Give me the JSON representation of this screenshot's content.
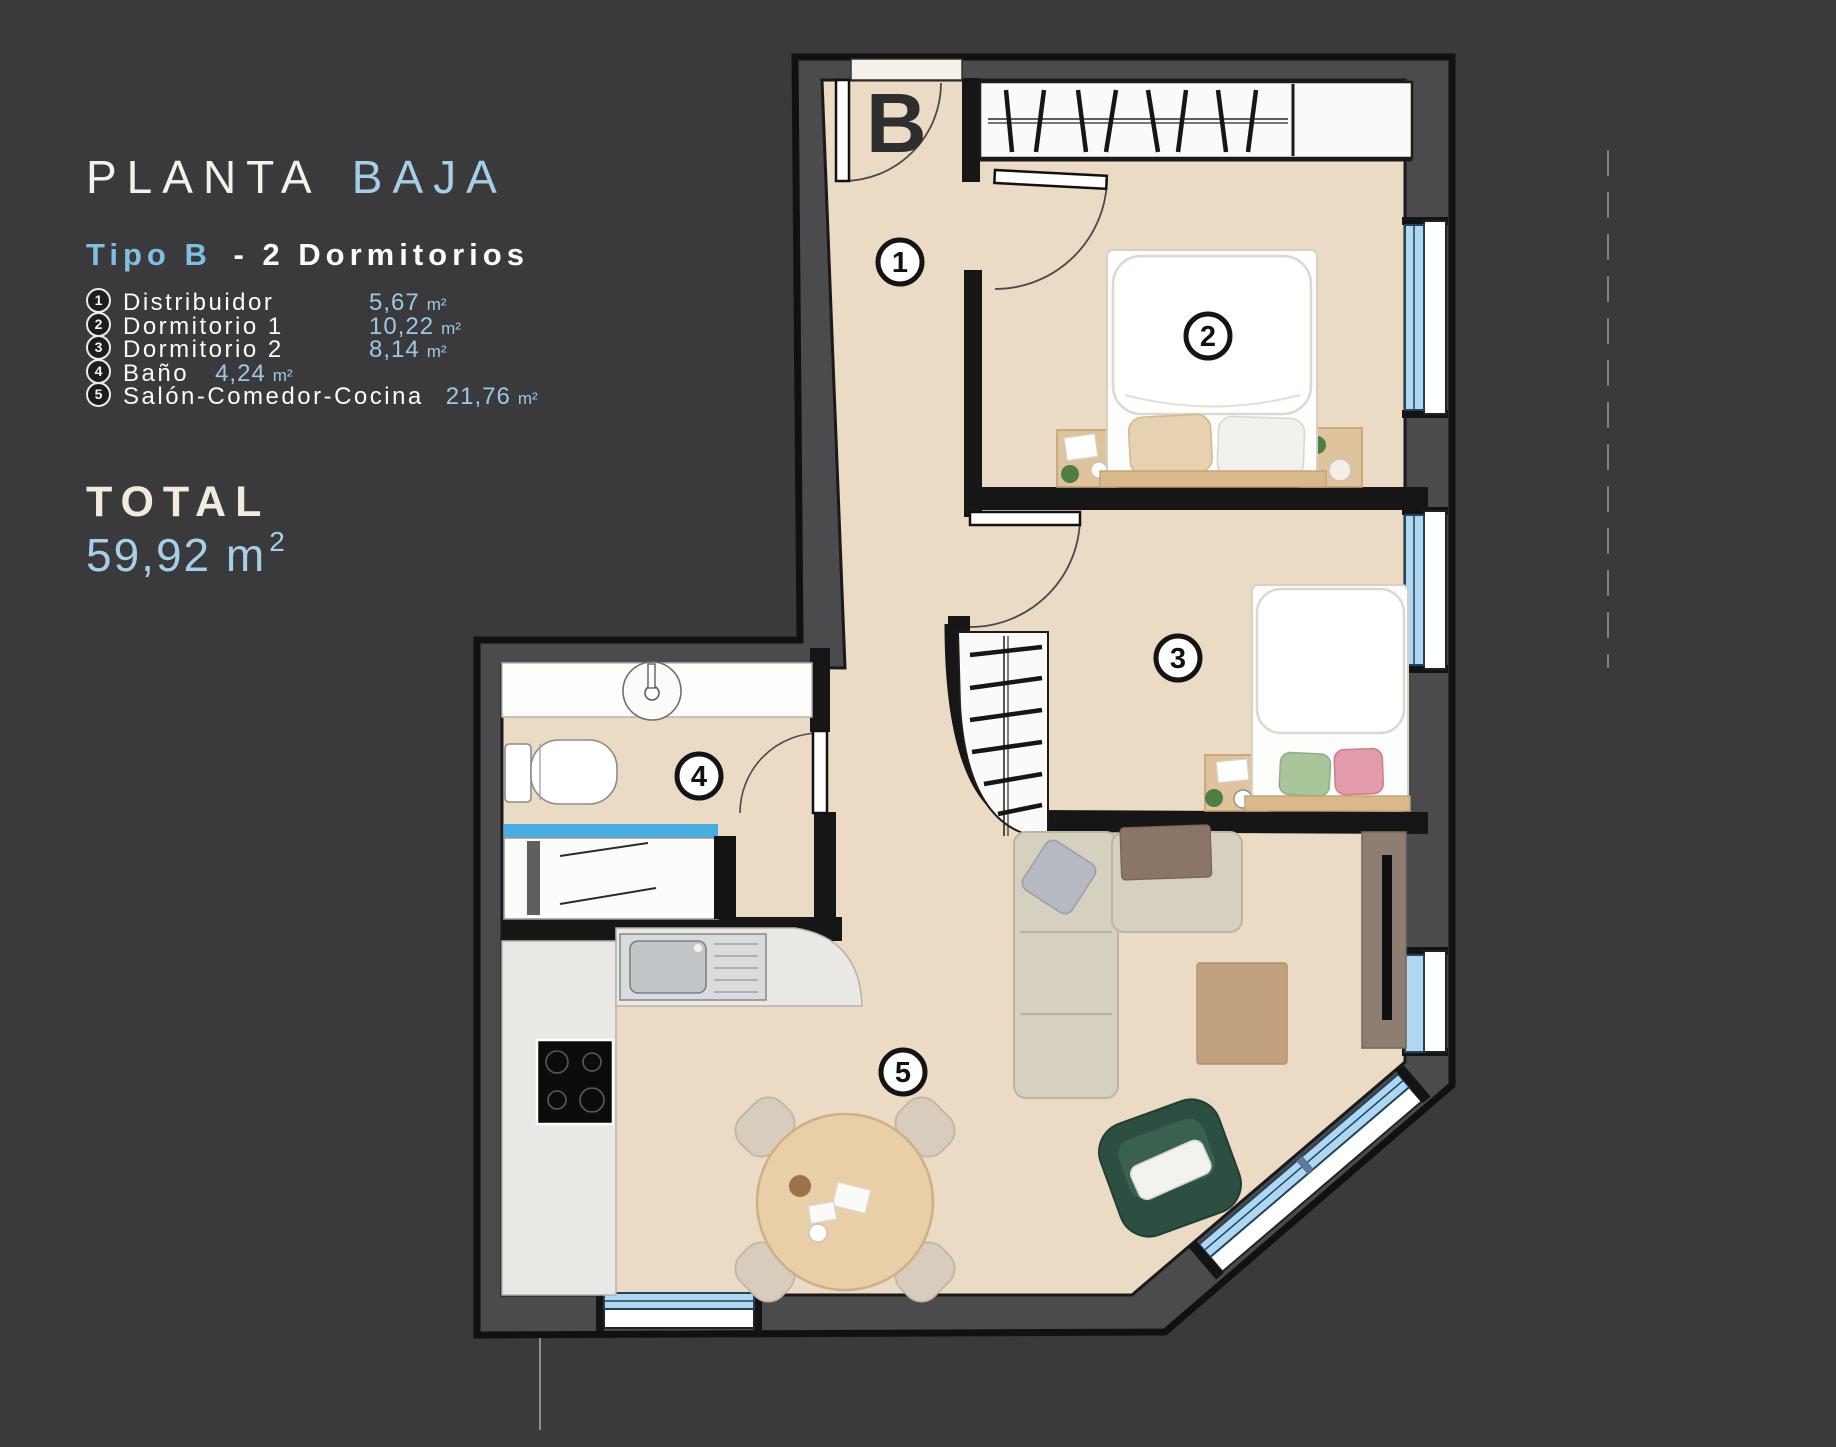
{
  "panel": {
    "title": {
      "primary": "PLANTA",
      "accent": "BAJA"
    },
    "subtitle": {
      "accent": "Tipo B",
      "rest": "-  2  Dormitorios"
    },
    "legend": [
      {
        "num": "1",
        "label": "Distribuidor",
        "area": "5,67",
        "unit": "m²"
      },
      {
        "num": "2",
        "label": "Dormitorio 1",
        "area": "10,22",
        "unit": "m²"
      },
      {
        "num": "3",
        "label": "Dormitorio 2",
        "area": "8,14",
        "unit": "m²"
      },
      {
        "num": "4",
        "label": "Baño",
        "area": "4,24",
        "unit": "m²"
      },
      {
        "num": "5",
        "label": "Salón-Comedor-Cocina",
        "area": "21,76",
        "unit": "m²"
      }
    ],
    "total": {
      "label": "TOTAL",
      "value": "59,92 m",
      "sup": "2"
    }
  },
  "plan": {
    "entrance_label": "B",
    "badges": [
      "1",
      "2",
      "3",
      "4",
      "5"
    ],
    "colors": {
      "background": "#3a3a3c",
      "wall_fill": "#4b4b4d",
      "wall_line": "#111111",
      "floor": "#ebdac4",
      "window_glass": "#aed7f2",
      "accent_blue": "#9cc8e3",
      "title_blue": "#a5cfe6",
      "total_cream": "#f1ebdd",
      "sofa_beige": "#d6d0bf",
      "armchair_green": "#2d4f41",
      "wood": "#d9b98c"
    }
  }
}
